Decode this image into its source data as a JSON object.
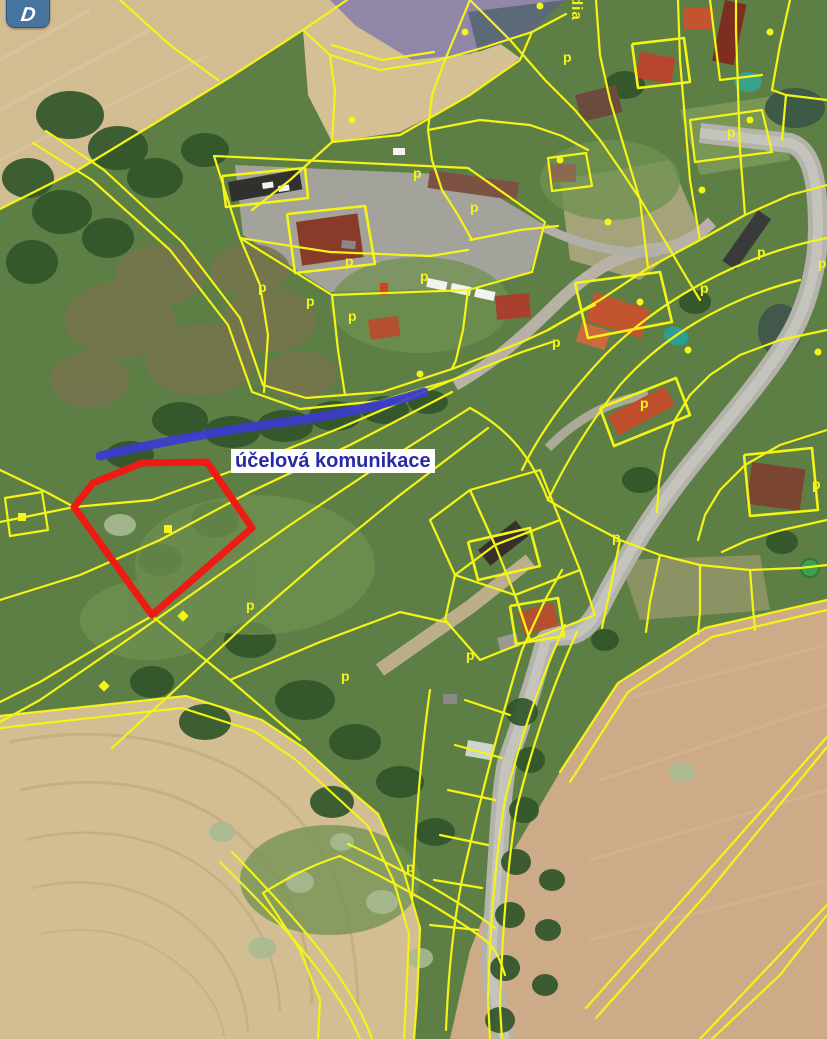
{
  "map": {
    "annotations": {
      "route_label": "účelová komunikace",
      "rotated_place_label": "dia"
    },
    "controls": {
      "pan_button_glyph": "D"
    },
    "colors": {
      "parcel_line": "#f4f416",
      "highlight_outline": "#ee1a14",
      "route_line": "#3c3cd0",
      "route_label_text": "#2929a8",
      "route_label_bg": "#ffffff",
      "control_button_bg": "#46749f",
      "symbol": "#f4f416"
    },
    "highlight_parcel": {
      "points": "74,507 93,483 142,463 207,462 252,528 152,615"
    },
    "route": {
      "path": "M100,456 C150,444 230,429 300,420 C355,412 400,400 424,392"
    },
    "symbols": {
      "p_markers": [
        [
          413,
          178
        ],
        [
          345,
          266
        ],
        [
          258,
          292
        ],
        [
          306,
          306
        ],
        [
          348,
          321
        ],
        [
          420,
          281
        ],
        [
          470,
          212
        ],
        [
          563,
          62
        ],
        [
          640,
          408
        ],
        [
          700,
          293
        ],
        [
          757,
          257
        ],
        [
          818,
          268
        ],
        [
          612,
          542
        ],
        [
          466,
          660
        ],
        [
          406,
          872
        ],
        [
          341,
          681
        ],
        [
          246,
          610
        ],
        [
          812,
          489
        ],
        [
          727,
          137
        ],
        [
          552,
          347
        ]
      ],
      "dot_markers": [
        [
          540,
          6
        ],
        [
          420,
          374
        ],
        [
          560,
          160
        ],
        [
          640,
          302
        ],
        [
          702,
          190
        ],
        [
          770,
          32
        ],
        [
          465,
          32
        ],
        [
          352,
          120
        ],
        [
          608,
          222
        ],
        [
          688,
          350
        ],
        [
          750,
          120
        ],
        [
          818,
          352
        ]
      ],
      "square_markers": [
        [
          168,
          529
        ],
        [
          22,
          517
        ]
      ],
      "diamond_markers": [
        [
          183,
          616
        ],
        [
          104,
          686
        ]
      ]
    }
  }
}
